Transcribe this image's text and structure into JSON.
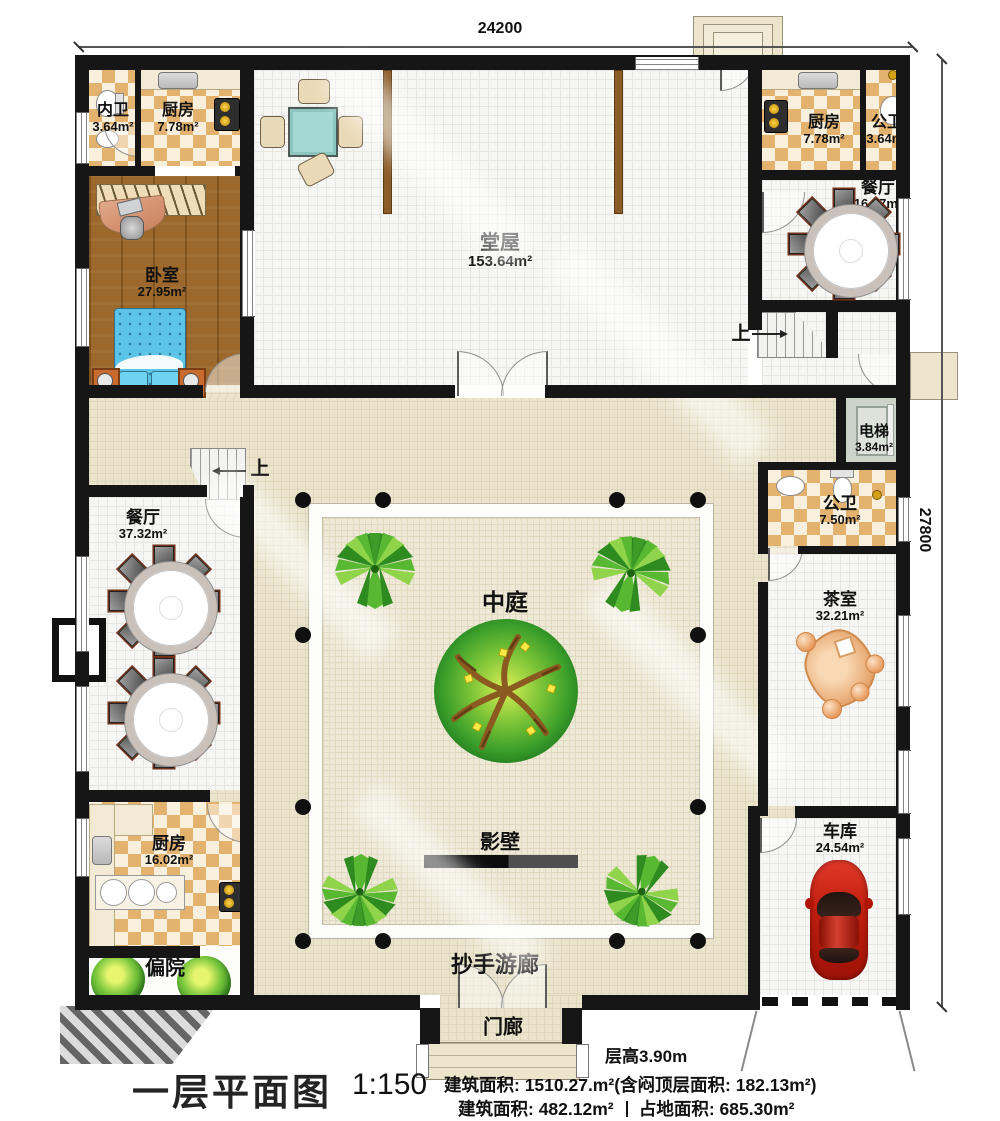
{
  "dimensions": {
    "top": "24200",
    "right": "27800"
  },
  "rooms": {
    "inner_bath": {
      "name": "内卫",
      "area": "3.64m²"
    },
    "kitchen_top_left": {
      "name": "厨房",
      "area": "7.78m²"
    },
    "bedroom": {
      "name": "卧室",
      "area": "27.95m²"
    },
    "main_hall": {
      "name": "堂屋",
      "area": "153.64m²"
    },
    "kitchen_top_right": {
      "name": "厨房",
      "area": "7.78m²"
    },
    "public_bath_top": {
      "name": "公卫",
      "area": "3.64m²"
    },
    "dining_top_right": {
      "name": "餐厅",
      "area": "16.87m²"
    },
    "elevator": {
      "name": "电梯",
      "area": "3.84m²"
    },
    "public_bath_mid": {
      "name": "公卫",
      "area": "7.50m²"
    },
    "tea_room": {
      "name": "茶室",
      "area": "32.21m²"
    },
    "garage": {
      "name": "车库",
      "area": "24.54m²"
    },
    "dining_left": {
      "name": "餐厅",
      "area": "37.32m²"
    },
    "kitchen_bottom_left": {
      "name": "厨房",
      "area": "16.02m²"
    }
  },
  "labels": {
    "courtyard": "中庭",
    "screen_wall": "影壁",
    "corridor": "抄手游廊",
    "porch": "门廊",
    "side_yard": "偏院",
    "stairs_up": "上"
  },
  "title_block": {
    "title": "一层平面图",
    "scale": "1:150",
    "floor_height": "层高3.90m",
    "area_line1": "建筑面积: 1510.27.m²(含闷顶层面积: 182.13m²)",
    "area_line2a": "建筑面积: 482.12m²",
    "area_line2b": "占地面积: 685.30m²"
  },
  "colors": {
    "wall": "#161616",
    "checker_tan": "#e3b26f",
    "corridor_beige": "#eae4cd",
    "tile_white": "#f6f6f4",
    "wood_floor": "#9c682c",
    "bed_blue": "#5cc4e6",
    "tree_green": "#3da32c",
    "car_red": "#c21f10",
    "tea_table_orange": "#e89a5e",
    "table_teal": "#a4d8d2"
  }
}
